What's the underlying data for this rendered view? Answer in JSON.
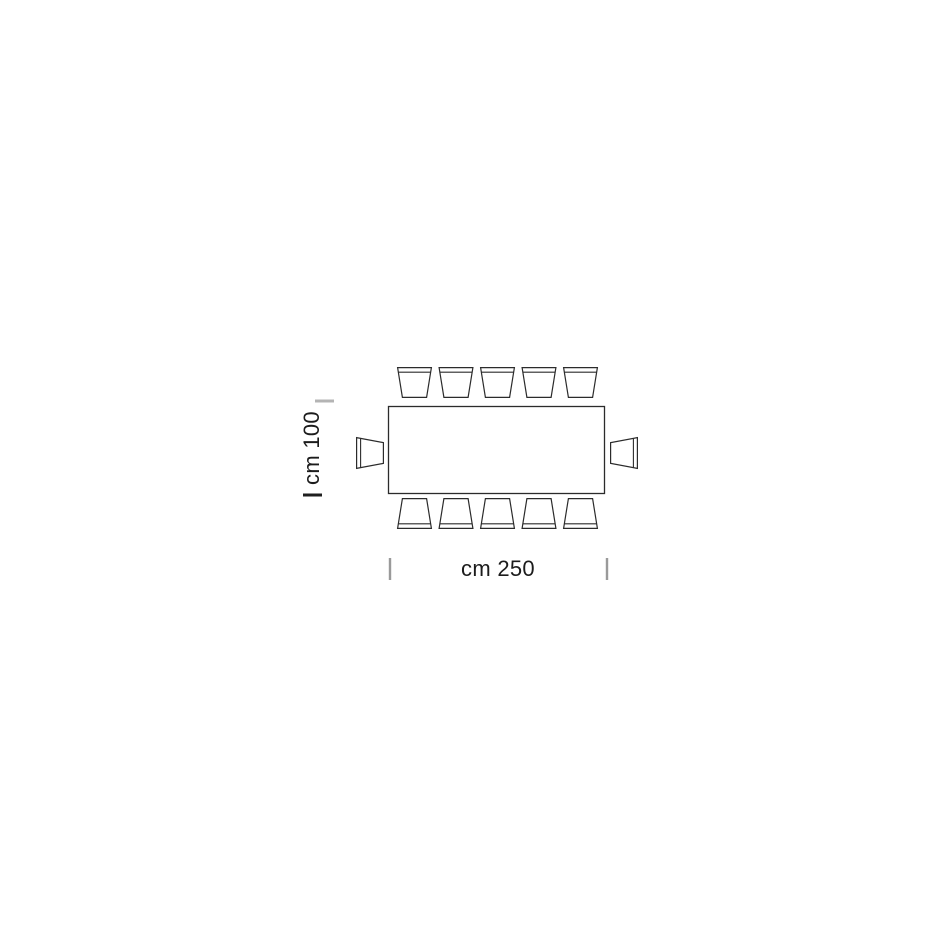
{
  "diagram": {
    "type": "furniture-plan-view",
    "subject": "rectangular table with 12 chairs (5 top, 5 bottom, 1 left, 1 right)",
    "width_label": "cm 250",
    "depth_label": "cm 100",
    "seats": {
      "top": 5,
      "bottom": 5,
      "left": 1,
      "right": 1,
      "total": 12
    },
    "colors": {
      "background": "#ffffff",
      "outline": "#2b2b2b",
      "tick_gray": "#9a9a9a",
      "tick_dark": "#1f1f1f"
    }
  }
}
